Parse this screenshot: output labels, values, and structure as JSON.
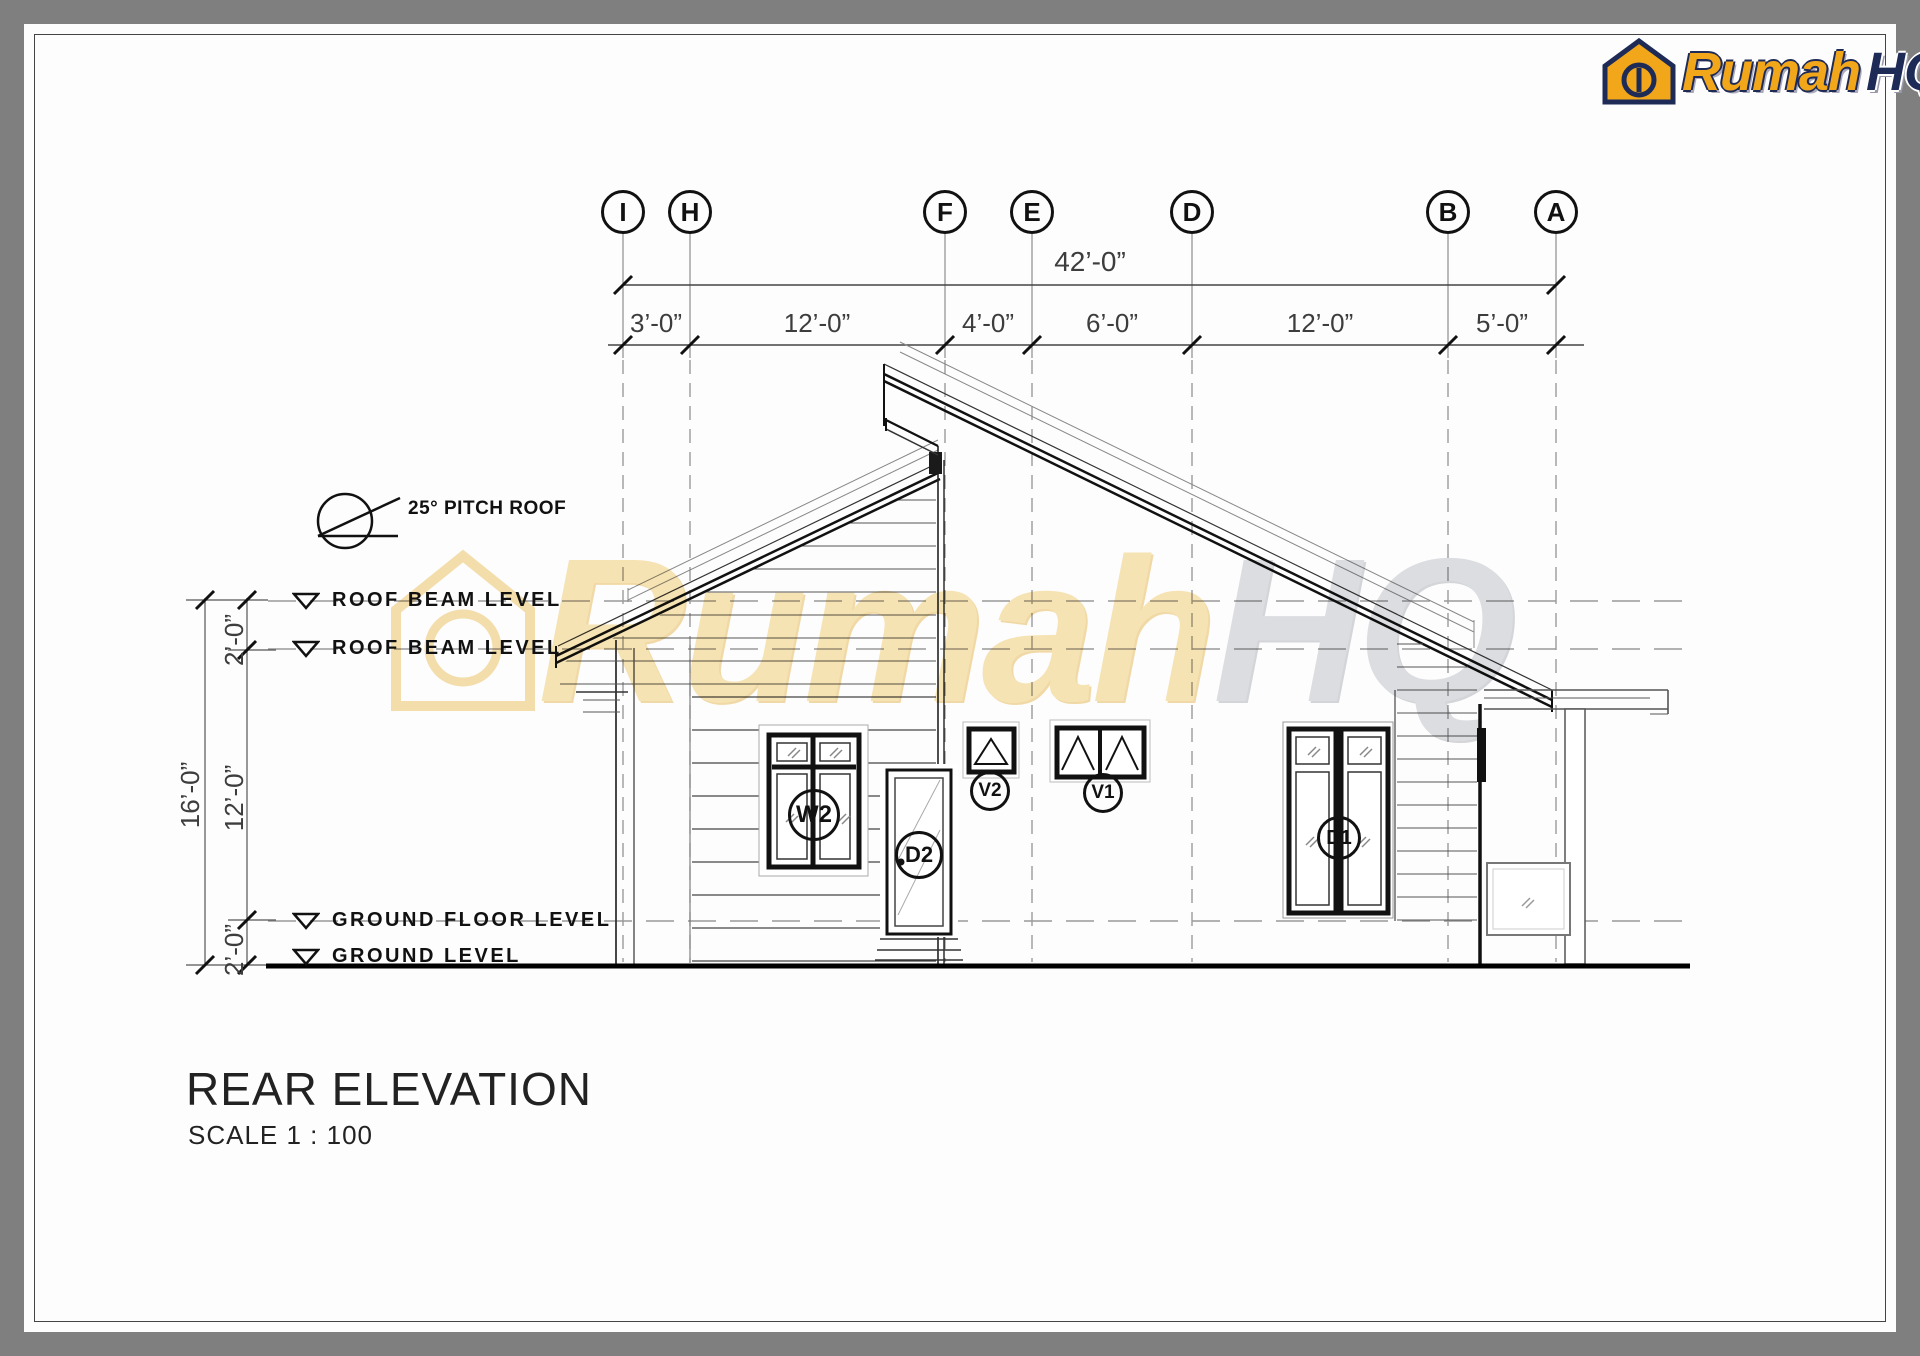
{
  "logo": {
    "brand_first": "Rumah",
    "brand_second": "HQ"
  },
  "grid": {
    "markers": [
      {
        "label": "I"
      },
      {
        "label": "H"
      },
      {
        "label": "F"
      },
      {
        "label": "E"
      },
      {
        "label": "D"
      },
      {
        "label": "B"
      },
      {
        "label": "A"
      }
    ]
  },
  "dimensions": {
    "total": "42’-0”",
    "segments": [
      {
        "label": "3’-0”"
      },
      {
        "label": "12’-0”"
      },
      {
        "label": "4’-0”"
      },
      {
        "label": "6’-0”"
      },
      {
        "label": "12’-0”"
      },
      {
        "label": "5’-0”"
      }
    ],
    "vertical": {
      "overall": "16’-0”",
      "top": "2’-0”",
      "middle": "12’-0”",
      "bottom": "2’-0”"
    }
  },
  "levels": {
    "roof_beam_upper": "ROOF BEAM LEVEL",
    "roof_beam_lower": "ROOF BEAM LEVEL",
    "ground_floor": "GROUND FLOOR LEVEL",
    "ground": "GROUND  LEVEL"
  },
  "annotations": {
    "roof_pitch": "25° PITCH ROOF"
  },
  "tags": {
    "window_left": "W2",
    "rear_door": "D2",
    "vent": "V2",
    "clerestory_window": "V1",
    "right_door": "D1"
  },
  "title_block": {
    "title": "REAR ELEVATION",
    "scale": "SCALE 1 : 100"
  },
  "watermark": {
    "first": "Rumah",
    "second": "HQ"
  },
  "colors": {
    "brand_gold": "#F2A71B",
    "brand_navy": "#1E2B57",
    "frame_gray": "#7F7F7F"
  }
}
